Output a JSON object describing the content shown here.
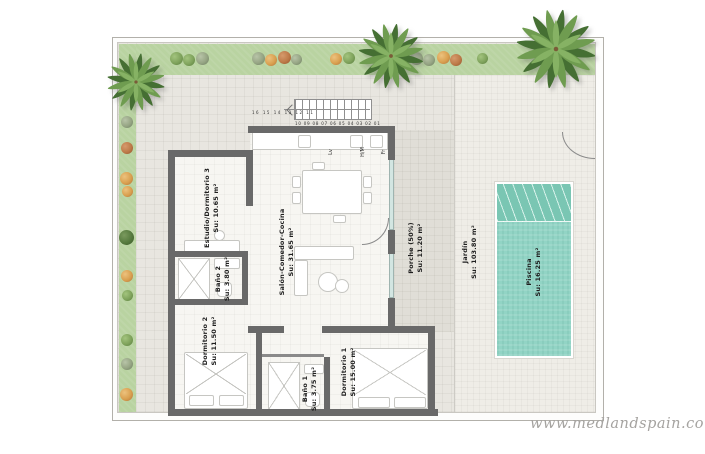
{
  "watermark": "www.medlandspain.com",
  "rooms": {
    "estudio": {
      "name": "Estudio/Dormitorio 3",
      "area": "Su: 10.65 m²"
    },
    "salon": {
      "name": "Salón-Comedor-Cocina",
      "area": "Su: 31.65 m²"
    },
    "bano2": {
      "name": "Baño 2",
      "area": "Su: 3.80 m²"
    },
    "dorm2": {
      "name": "Dormitorio 2",
      "area": "Su: 11.50 m²"
    },
    "bano1": {
      "name": "Baño 1",
      "area": "Su: 3.75 m²"
    },
    "dorm1": {
      "name": "Dormitorio 1",
      "area": "Su: 15.00 m²"
    },
    "porche": {
      "name": "Porche (50%)",
      "area": "Su: 11.20 m²"
    },
    "jardin": {
      "name": "Jardín",
      "area": "Su: 103.80 m²"
    },
    "piscina": {
      "name": "Piscina",
      "area": "Su: 16.25 m²"
    }
  },
  "kitchen": {
    "dishwasher": "Lv",
    "washer_dryer": "H/M",
    "fridge": "Fr"
  },
  "stairs": {
    "left_numbers": "16 15 14 13 12 11",
    "right_numbers": "10 09 08 07 06 05 04 03 02 01"
  },
  "colors": {
    "pool_water": "#92d4c5",
    "pool_steps": "#7ac6b3",
    "lawn": "#b9d3a1",
    "courtyard_tile": "#e8e6e0",
    "garden_tile": "#efede7",
    "wall": "#696969",
    "glass": "#d3e6e2",
    "watermark_text": "#a5a3a0"
  }
}
